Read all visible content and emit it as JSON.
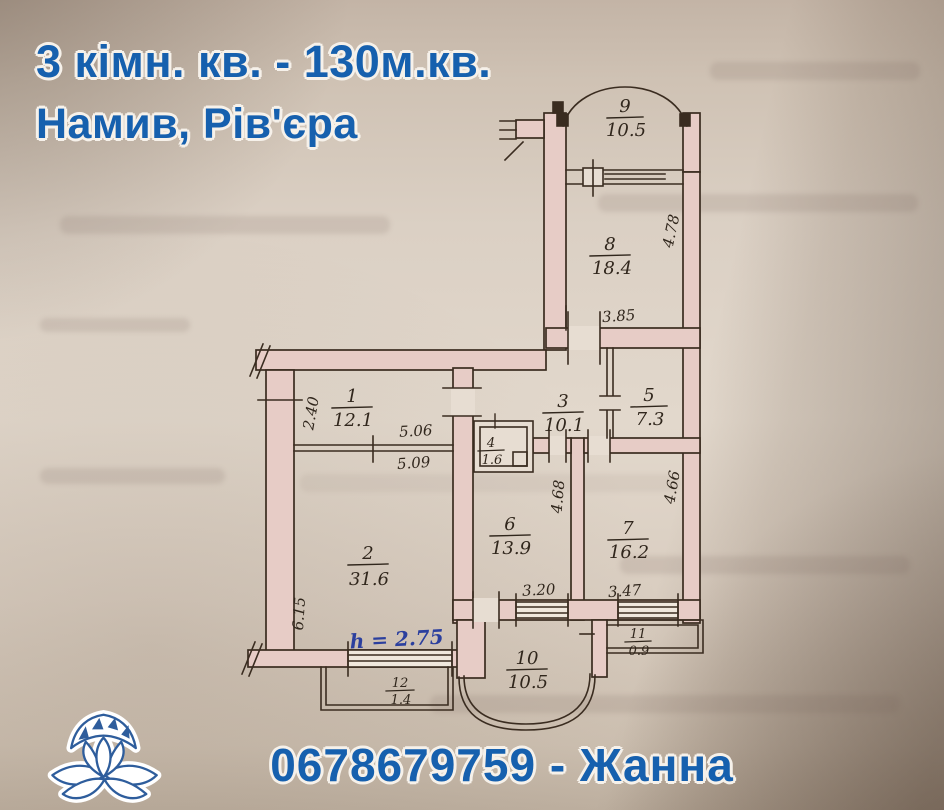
{
  "header": {
    "title_line1": "3 кімн. кв. - 130м.кв.",
    "title_line2": "Намив, Рів'єра"
  },
  "footer": {
    "phone_label": "0678679759 - Жанна"
  },
  "logo": {
    "icon": "lotus-icon"
  },
  "colors": {
    "accent_blue": "#1660ae",
    "handwriting_ink_blue": "#2b3f9e",
    "wall_fill_pink": "#e7ccc6",
    "drawing_line": "#3a2c20"
  },
  "floorplan": {
    "rooms": [
      {
        "number": "9",
        "area": "10.5"
      },
      {
        "number": "8",
        "area": "18.4"
      },
      {
        "number": "1",
        "area": "12.1"
      },
      {
        "number": "3",
        "area": "10.1"
      },
      {
        "number": "5",
        "area": "7.3"
      },
      {
        "number": "4",
        "area": "1.6"
      },
      {
        "number": "2",
        "area": "31.6"
      },
      {
        "number": "6",
        "area": "13.9"
      },
      {
        "number": "7",
        "area": "16.2"
      },
      {
        "number": "10",
        "area": "10.5"
      },
      {
        "number": "11",
        "area": "0.9"
      },
      {
        "number": "12",
        "area": "1.4"
      }
    ],
    "dimensions": {
      "room8_right": "4.78",
      "room8_bottom": "3.85",
      "room1_left": "2.40",
      "room1_width_inner": "5.06",
      "room1_width_outer": "5.09",
      "room6_right": "4.68",
      "room7_right": "4.66",
      "room6_bottom": "3.20",
      "room7_bottom": "3.47",
      "room2_left": "6.15",
      "ceiling_height_note": "h = 2.75"
    }
  }
}
